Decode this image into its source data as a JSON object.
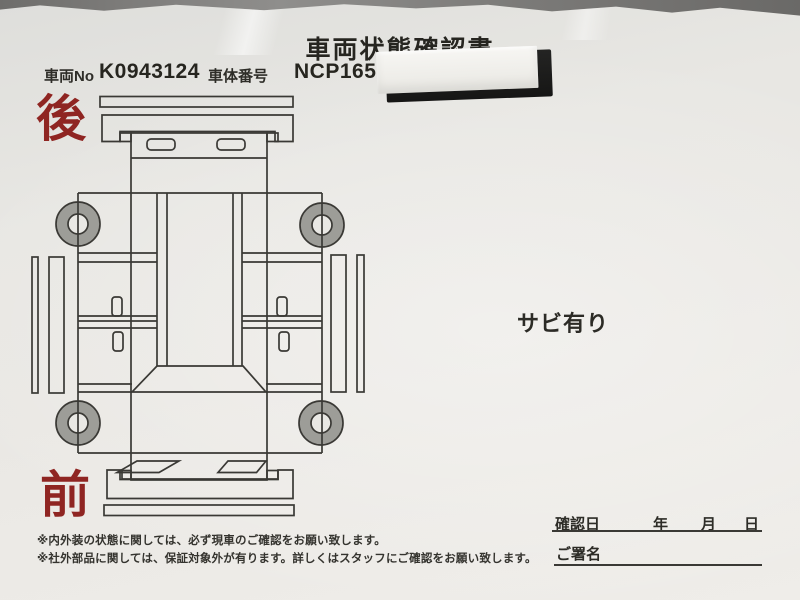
{
  "page": {
    "title": "車両状態確認書"
  },
  "header": {
    "vehicle_no_label": "車両No",
    "vehicle_no_value": "K0943124",
    "body_no_label": "車体番号",
    "body_no_value": "NCP165-",
    "masking_sticker": "white label sticker over black bar hiding rest of chassis number"
  },
  "diagram": {
    "type": "car-top-view-condition-sheet",
    "rear_label": "後",
    "front_label": "前",
    "label_color": "#8f2522",
    "line_color": "#3a3935",
    "wheel_fill": "#9d9d98",
    "paper_color": "#eae8e4"
  },
  "annotations": {
    "rust_note": "サビ有り"
  },
  "signature": {
    "confirm_date_label": "確認日",
    "year_label": "年",
    "month_label": "月",
    "day_label": "日",
    "signature_label": "ご署名"
  },
  "footnotes": [
    "※内外装の状態に関しては、必ず現車のご確認をお願い致します。",
    "※社外部品に関しては、保証対象外が有ります。詳しくはスタッフにご確認をお願い致します。"
  ]
}
